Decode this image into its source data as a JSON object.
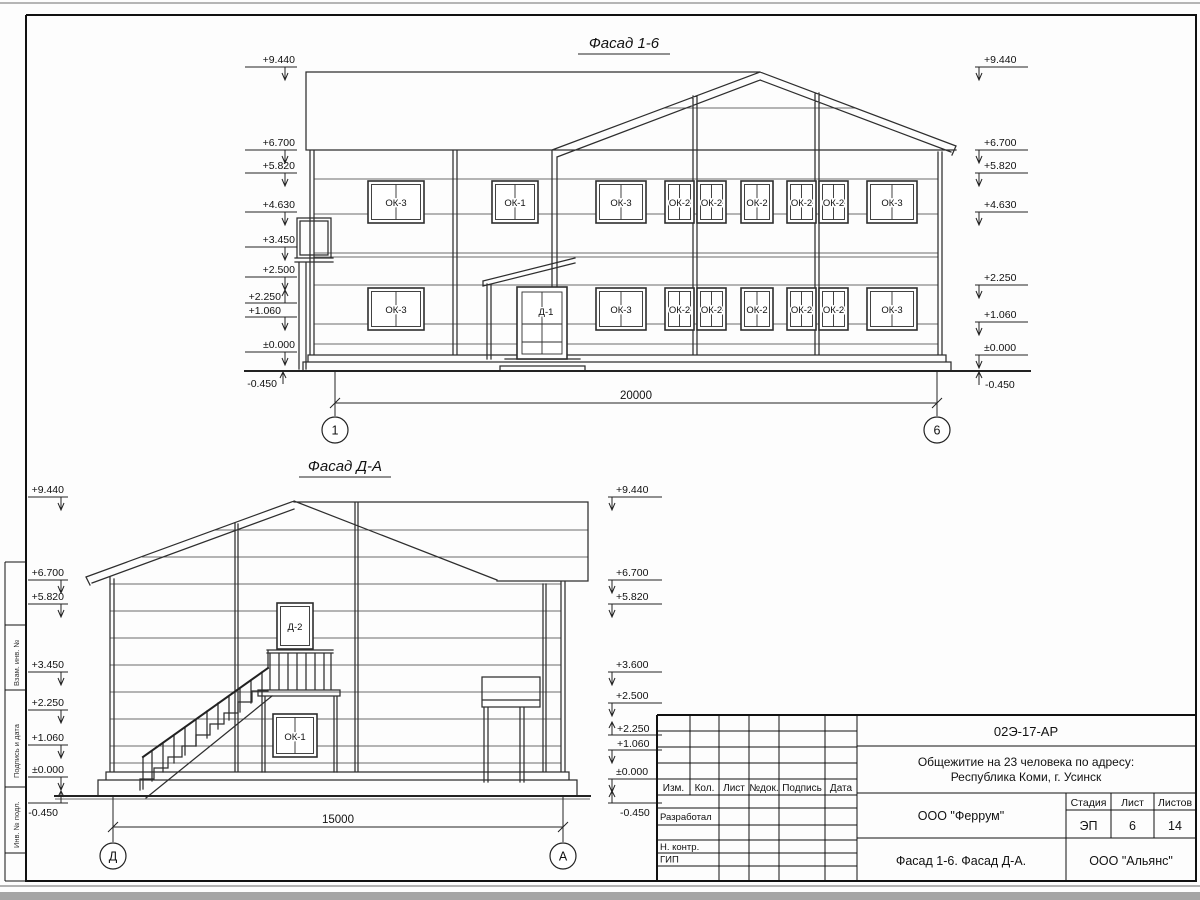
{
  "f16": {
    "title": "Фасад 1-6",
    "marks_left": [
      "+9.440",
      "+6.700",
      "+5.820",
      "+4.630",
      "+3.450",
      "+2.500",
      "+2.250",
      "+1.060",
      "±0.000",
      "-0.450"
    ],
    "marks_right": [
      "+9.440",
      "+6.700",
      "+5.820",
      "+4.630",
      "+2.250",
      "+1.060",
      "±0.000",
      "-0.450"
    ],
    "windows_upper": [
      "ОК-3",
      "ОК-1",
      "ОК-3",
      "ОК-2",
      "ОК-2",
      "ОК-2",
      "ОК-2",
      "ОК-2",
      "ОК-3"
    ],
    "windows_lower": [
      "ОК-3",
      "ОК-3",
      "ОК-2",
      "ОК-2",
      "ОК-2",
      "ОК-2",
      "ОК-2",
      "ОК-3"
    ],
    "door": "Д-1",
    "dim": "20000",
    "axis_left": "1",
    "axis_right": "6"
  },
  "fda": {
    "title": "Фасад Д-А",
    "marks_left": [
      "+9.440",
      "+6.700",
      "+5.820",
      "+3.450",
      "+2.250",
      "+1.060",
      "±0.000",
      "-0.450"
    ],
    "marks_right": [
      "+9.440",
      "+6.700",
      "+5.820",
      "+3.600",
      "+2.500",
      "+2.250",
      "+1.060",
      "±0.000",
      "-0.450"
    ],
    "door": "Д-2",
    "window": "ОК-1",
    "dim": "15000",
    "axis_left": "Д",
    "axis_right": "А"
  },
  "tb": {
    "doc_number": "02Э-17-АР",
    "project_line1": "Общежитие на 23 человека по адресу:",
    "project_line2": "Республика Коми, г. Усинск",
    "header": [
      "Изм.",
      "Кол.",
      "Лист",
      "№док.",
      "Подпись",
      "Дата"
    ],
    "roles": [
      "Разработал",
      "Н. контр.",
      "ГИП"
    ],
    "designer": "ООО \"Феррум\"",
    "stage_label": "Стадия",
    "sheet_label": "Лист",
    "sheets_label": "Листов",
    "stage": "ЭП",
    "sheet": "6",
    "sheets": "14",
    "sheet_title": "Фасад 1-6. Фасад Д-А.",
    "customer": "ООО \"Альянс\""
  },
  "frame": {
    "stamps": [
      "Взам. инв. №",
      "Подпись и дата",
      "Инв. № подл."
    ]
  }
}
